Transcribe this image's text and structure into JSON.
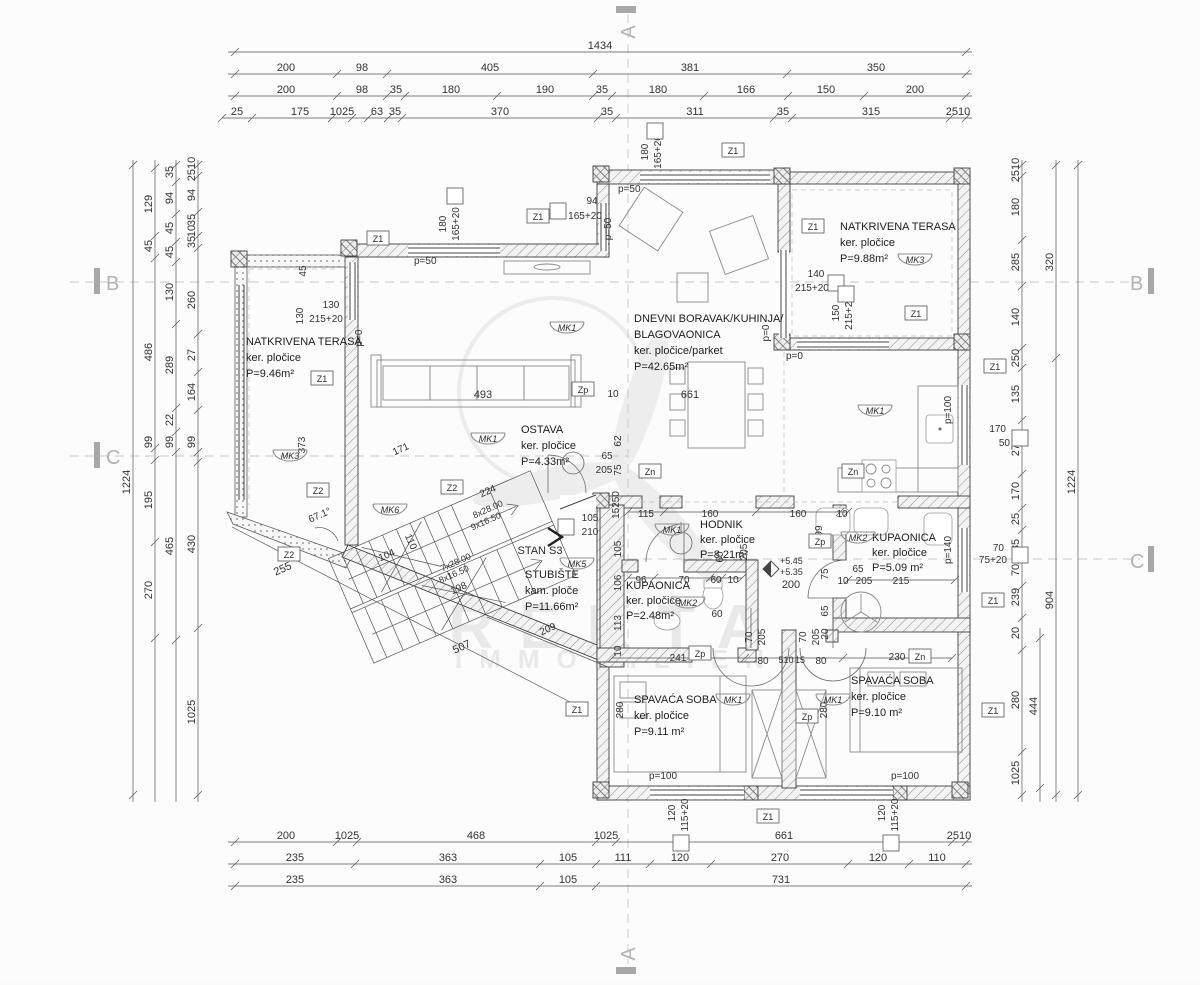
{
  "watermark": {
    "title": "REKTA",
    "subtitle": "IMMOBILIEN"
  },
  "axes": {
    "a": "A",
    "b": "B",
    "c": "C"
  },
  "stan_label": "STAN S3",
  "rooms": {
    "terasa_l": [
      "NATKRIVENA TERASA",
      "ker. pločice",
      "P=9.46m²"
    ],
    "terasa_r": [
      "NATKRIVENA TERASA",
      "ker. pločice",
      "P=9.88m²"
    ],
    "dnevni": [
      "DNEVNI BORAVAK/KUHINJA/",
      "BLAGOVAONICA",
      "ker. pločice/parket",
      "P=42.65m²"
    ],
    "ostava": [
      "OSTAVA",
      "ker. pločice",
      "P=4.33m²"
    ],
    "stubiste": [
      "STUBIŠTE",
      "kam. ploče",
      "P=11.66m²"
    ],
    "hodnik": [
      "HODNIK",
      "ker. pločice",
      "P=8.21m²"
    ],
    "kupaonica_m": [
      "KUPAONICA",
      "ker. pločice",
      "P=2.48m²"
    ],
    "kupaonica_v": [
      "KUPAONICA",
      "ker. pločice",
      "P=5.09 m²"
    ],
    "spavaca_l": [
      "SPAVAĆA SOBA",
      "ker. pločice",
      "P=9.11 m²"
    ],
    "spavaca_r": [
      "SPAVAĆA SOBA",
      "ker. pločice",
      "P=9.10 m²"
    ]
  },
  "h_dims": [
    {
      "y": 52,
      "x1": 228,
      "x2": 972,
      "ticks": [
        235,
        966
      ],
      "labels": [
        [
          "1434",
          600
        ]
      ]
    },
    {
      "y": 74,
      "x1": 228,
      "x2": 972,
      "ticks": [
        235,
        337,
        387,
        593,
        787,
        966
      ],
      "labels": [
        [
          "200",
          286
        ],
        [
          "98",
          362
        ],
        [
          "405",
          490
        ],
        [
          "381",
          690
        ],
        [
          "350",
          876
        ]
      ]
    },
    {
      "y": 96,
      "x1": 228,
      "x2": 972,
      "ticks": [
        235,
        337,
        387,
        405,
        497,
        593,
        612,
        704,
        788,
        864,
        966
      ],
      "labels": [
        [
          "200",
          286
        ],
        [
          "98",
          362
        ],
        [
          "35",
          396
        ],
        [
          "180",
          451
        ],
        [
          "190",
          545
        ],
        [
          "35",
          602
        ],
        [
          "180",
          658
        ],
        [
          "166",
          746
        ],
        [
          "150",
          826
        ],
        [
          "200",
          915
        ]
      ]
    },
    {
      "y": 118,
      "x1": 222,
      "x2": 972,
      "ticks": [
        222,
        252,
        332,
        352,
        368,
        388,
        402,
        598,
        616,
        774,
        792,
        950,
        966
      ],
      "labels": [
        [
          "25",
          237
        ],
        [
          "175",
          300
        ],
        [
          "1025",
          342
        ],
        [
          "63",
          377
        ],
        [
          "35",
          395
        ],
        [
          "370",
          500
        ],
        [
          "35",
          607
        ],
        [
          "311",
          695
        ],
        [
          "35",
          783
        ],
        [
          "315",
          871
        ],
        [
          "2510",
          958
        ]
      ]
    },
    {
      "y": 842,
      "x1": 228,
      "x2": 972,
      "ticks": [
        235,
        337,
        357,
        596,
        616,
        952,
        966
      ],
      "labels": [
        [
          "200",
          286
        ],
        [
          "1025",
          347
        ],
        [
          "468",
          476
        ],
        [
          "1025",
          606
        ],
        [
          "661",
          784
        ],
        [
          "2510",
          959
        ]
      ]
    },
    {
      "y": 864,
      "x1": 228,
      "x2": 972,
      "ticks": [
        235,
        355,
        540,
        596,
        650,
        711,
        848,
        909,
        966
      ],
      "labels": [
        [
          "235",
          295
        ],
        [
          "363",
          448
        ],
        [
          "105",
          568
        ],
        [
          "111",
          623
        ],
        [
          "120",
          680
        ],
        [
          "270",
          780
        ],
        [
          "120",
          878
        ],
        [
          "110",
          937
        ]
      ]
    },
    {
      "y": 886,
      "x1": 228,
      "x2": 972,
      "ticks": [
        235,
        540,
        596,
        966
      ],
      "labels": [
        [
          "235",
          295
        ],
        [
          "363",
          448
        ],
        [
          "105",
          568
        ],
        [
          "731",
          781
        ]
      ]
    },
    {
      "y": 512,
      "x1": 628,
      "x2": 848,
      "ticks": [
        628,
        664,
        756,
        840,
        848
      ],
      "labels": []
    },
    {
      "y": 578,
      "x1": 628,
      "x2": 742,
      "ticks": [
        628,
        654,
        710,
        722,
        742
      ],
      "labels": []
    },
    {
      "y": 658,
      "x1": 612,
      "x2": 952,
      "ticks": [
        612,
        745,
        843,
        952
      ],
      "labels": []
    },
    {
      "y": 580,
      "x1": 848,
      "x2": 955,
      "ticks": [
        848,
        955
      ],
      "labels": []
    }
  ],
  "v_dims": [
    {
      "x": 133,
      "y1": 160,
      "y2": 802,
      "ticks": [
        165,
        795
      ],
      "labels": [
        [
          "1224",
          482
        ]
      ]
    },
    {
      "x": 155,
      "y1": 160,
      "y2": 802,
      "ticks": [
        168,
        236,
        258,
        448,
        460,
        542,
        638
      ],
      "labels": [
        [
          "129",
          204
        ],
        [
          "45",
          246
        ],
        [
          "486",
          352
        ],
        [
          "99",
          442
        ],
        [
          "195",
          500
        ],
        [
          "270",
          590
        ]
      ]
    },
    {
      "x": 176,
      "y1": 160,
      "y2": 802,
      "ticks": [
        165,
        182,
        214,
        242,
        262,
        324,
        408,
        432,
        452,
        640
      ],
      "labels": [
        [
          "35",
          172
        ],
        [
          "94",
          198
        ],
        [
          "45",
          228
        ],
        [
          "45",
          252
        ],
        [
          "130",
          292
        ],
        [
          "289",
          365
        ],
        [
          "22",
          420
        ],
        [
          "99",
          442
        ],
        [
          "465",
          546
        ]
      ]
    },
    {
      "x": 198,
      "y1": 160,
      "y2": 802,
      "ticks": [
        165,
        176,
        212,
        236,
        248,
        334,
        372,
        410,
        452,
        462,
        628,
        795
      ],
      "labels": [
        [
          "2510",
          169
        ],
        [
          "94",
          195
        ],
        [
          "35",
          220
        ],
        [
          "10",
          231
        ],
        [
          "35",
          242
        ],
        [
          "260",
          300
        ],
        [
          "27",
          355
        ],
        [
          "164",
          392
        ],
        [
          "99",
          442
        ],
        [
          "430",
          544
        ],
        [
          "1025",
          712
        ]
      ]
    },
    {
      "x": 1022,
      "y1": 160,
      "y2": 802,
      "ticks": [
        165,
        176,
        240,
        286,
        348,
        368,
        420,
        474,
        508,
        530,
        560,
        586,
        618,
        650,
        752,
        795
      ],
      "labels": [
        [
          "2510",
          170
        ],
        [
          "180",
          207
        ],
        [
          "285",
          262
        ],
        [
          "140",
          317
        ],
        [
          "250",
          358
        ],
        [
          "135",
          394
        ],
        [
          "270",
          447
        ],
        [
          "170",
          491
        ],
        [
          "25",
          519
        ],
        [
          "85",
          545
        ],
        [
          "70",
          570
        ],
        [
          "239",
          597
        ],
        [
          "20",
          633
        ],
        [
          "280",
          700
        ],
        [
          "1025",
          773
        ]
      ]
    },
    {
      "x": 1040,
      "y1": 628,
      "y2": 802,
      "ticks": [
        638,
        788
      ],
      "labels": [
        [
          "444",
          706
        ]
      ]
    },
    {
      "x": 1056,
      "y1": 160,
      "y2": 802,
      "ticks": [
        165,
        358,
        795
      ],
      "labels": [
        [
          "320",
          262
        ],
        [
          "904",
          600
        ]
      ]
    },
    {
      "x": 1078,
      "y1": 160,
      "y2": 802,
      "ticks": [
        165,
        795
      ],
      "labels": [
        [
          "1224",
          482
        ]
      ]
    }
  ],
  "labels": [
    [
      "180",
      648,
      152,
      -90
    ],
    [
      "165+20",
      661,
      152,
      -90
    ],
    [
      "94",
      592,
      204
    ],
    [
      "165+20",
      585,
      219
    ],
    [
      "180",
      446,
      224,
      -90
    ],
    [
      "165+20",
      459,
      224,
      -90
    ],
    [
      "p=50",
      618,
      192,
      0,
      10,
      "s"
    ],
    [
      "p=50",
      611,
      229,
      -90
    ],
    [
      "p=50",
      414,
      264,
      0,
      10,
      "s"
    ],
    [
      "p=0",
      769,
      333,
      -90
    ],
    [
      "p=0",
      786,
      359,
      0,
      10,
      "s"
    ],
    [
      "p=0",
      362,
      338,
      -90
    ],
    [
      "140",
      816,
      277
    ],
    [
      "215+20",
      812,
      291
    ],
    [
      "150",
      839,
      313,
      -90
    ],
    [
      "215+20",
      852,
      313,
      -90
    ],
    [
      "130",
      303,
      316,
      -90
    ],
    [
      "130",
      331,
      308
    ],
    [
      "215+20",
      326,
      322
    ],
    [
      "45",
      306,
      271,
      -90
    ],
    [
      "373",
      305,
      445,
      -90
    ],
    [
      "493",
      483,
      398,
      0,
      11
    ],
    [
      "661",
      690,
      398,
      0,
      11
    ],
    [
      "10",
      613,
      397
    ],
    [
      "62",
      621,
      441,
      -90
    ],
    [
      "75",
      621,
      470,
      -90
    ],
    [
      "15250",
      619,
      505,
      -90
    ],
    [
      "105",
      621,
      549,
      -90
    ],
    [
      "106",
      621,
      583,
      -90
    ],
    [
      "113",
      621,
      623,
      -90
    ],
    [
      "10",
      621,
      651,
      -90
    ],
    [
      "99",
      822,
      531,
      -90
    ],
    [
      "+5.45",
      780,
      564,
      0,
      9,
      "s"
    ],
    [
      "+5.35",
      780,
      575,
      0,
      9,
      "s"
    ],
    [
      "105",
      590,
      521
    ],
    [
      "210",
      590,
      535
    ],
    [
      "65",
      607,
      459
    ],
    [
      "205",
      604,
      473
    ],
    [
      "60",
      723,
      557,
      -90
    ],
    [
      "205",
      747,
      552,
      -90
    ],
    [
      "65",
      858,
      572
    ],
    [
      "10",
      843,
      584
    ],
    [
      "205",
      864,
      584
    ],
    [
      "75",
      828,
      574,
      -90
    ],
    [
      "65",
      828,
      611,
      -90
    ],
    [
      "20",
      828,
      634,
      -90
    ],
    [
      "230",
      897,
      660
    ],
    [
      "241",
      678,
      661
    ],
    [
      "80",
      763,
      664
    ],
    [
      "510",
      786,
      663,
      0,
      9
    ],
    [
      "15",
      800,
      663,
      0,
      9
    ],
    [
      "80",
      821,
      664
    ],
    [
      "70",
      752,
      637,
      -90
    ],
    [
      "205",
      765,
      637,
      -90
    ],
    [
      "70",
      806,
      637,
      -90
    ],
    [
      "205",
      819,
      637,
      -90
    ],
    [
      "280",
      623,
      710,
      -90
    ],
    [
      "280",
      827,
      710,
      -90
    ],
    [
      "60",
      717,
      617
    ],
    [
      "p=100",
      663,
      779
    ],
    [
      "p=100",
      905,
      779
    ],
    [
      "120",
      675,
      813,
      -90
    ],
    [
      "115+20",
      688,
      815,
      -90
    ],
    [
      "120",
      885,
      813,
      -90
    ],
    [
      "115+20",
      898,
      815,
      -90
    ],
    [
      "p=100",
      951,
      410,
      -90
    ],
    [
      "p=140",
      951,
      550,
      -90
    ],
    [
      "170",
      1006,
      432,
      0,
      10,
      "e"
    ],
    [
      "50",
      1010,
      446,
      0,
      10,
      "e"
    ],
    [
      "70",
      1004,
      551,
      0,
      10,
      "e"
    ],
    [
      "75+20",
      1007,
      563,
      0,
      10,
      "e"
    ],
    [
      "224",
      489,
      494,
      -24
    ],
    [
      "8x28.00",
      489,
      512,
      -24,
      9
    ],
    [
      "9x16.50",
      487,
      524,
      -24,
      9
    ],
    [
      "7x28.00",
      457,
      565,
      -24,
      9
    ],
    [
      "8x16.50",
      455,
      577,
      -24,
      9
    ],
    [
      "198",
      460,
      591,
      -24
    ],
    [
      "110",
      408,
      543,
      66
    ],
    [
      "104",
      388,
      558,
      -24
    ],
    [
      "171",
      402,
      452,
      -24
    ],
    [
      "67.1°",
      321,
      518,
      -24
    ],
    [
      "255",
      284,
      572,
      -24,
      11
    ],
    [
      "507",
      463,
      650,
      -24,
      11
    ],
    [
      "209",
      549,
      632,
      -24
    ],
    [
      "115",
      646,
      517
    ],
    [
      "160",
      710,
      517
    ],
    [
      "160",
      798,
      517
    ],
    [
      "10",
      842,
      517
    ],
    [
      "96",
      641,
      583
    ],
    [
      "70",
      684,
      583
    ],
    [
      "60",
      716,
      583
    ],
    [
      "10",
      733,
      583
    ],
    [
      "200",
      791,
      588,
      0,
      11
    ],
    [
      "215",
      901,
      584
    ]
  ],
  "zboxes": [
    [
      "Z1",
      378,
      240
    ],
    [
      "Z1",
      538,
      218
    ],
    [
      "Z1",
      733,
      152
    ],
    [
      "Z1",
      813,
      228
    ],
    [
      "Z1",
      916,
      315
    ],
    [
      "Z1",
      322,
      380
    ],
    [
      "Z2",
      318,
      492
    ],
    [
      "Z2",
      289,
      556
    ],
    [
      "Z2",
      452,
      489
    ],
    [
      "Zp",
      583,
      391
    ],
    [
      "Zn",
      650,
      473
    ],
    [
      "Zp",
      820,
      543
    ],
    [
      "Zn",
      853,
      473
    ],
    [
      "Zp",
      700,
      655
    ],
    [
      "Zp",
      807,
      718
    ],
    [
      "Zn",
      920,
      658
    ],
    [
      "Z1",
      577,
      711
    ],
    [
      "Z1",
      768,
      818
    ],
    [
      "Z1",
      995,
      368
    ],
    [
      "Z1",
      993,
      602
    ],
    [
      "Z1",
      993,
      712
    ]
  ],
  "mks": [
    [
      "MK3",
      290,
      458
    ],
    [
      "MK1",
      567,
      330
    ],
    [
      "MK1",
      488,
      441
    ],
    [
      "MK6",
      390,
      512
    ],
    [
      "MK5",
      577,
      566
    ],
    [
      "MK1",
      672,
      532
    ],
    [
      "MK2",
      688,
      605
    ],
    [
      "MK2",
      858,
      540
    ],
    [
      "MK1",
      875,
      413
    ],
    [
      "MK3",
      915,
      262
    ],
    [
      "MK1",
      733,
      702
    ],
    [
      "MK1",
      833,
      702
    ]
  ],
  "squares": [
    [
      655,
      131
    ],
    [
      455,
      196
    ],
    [
      558,
      211
    ],
    [
      836,
      283
    ],
    [
      846,
      294
    ],
    [
      566,
      527
    ],
    [
      681,
      843
    ],
    [
      891,
      843
    ],
    [
      1020,
      438
    ],
    [
      1020,
      555
    ]
  ]
}
